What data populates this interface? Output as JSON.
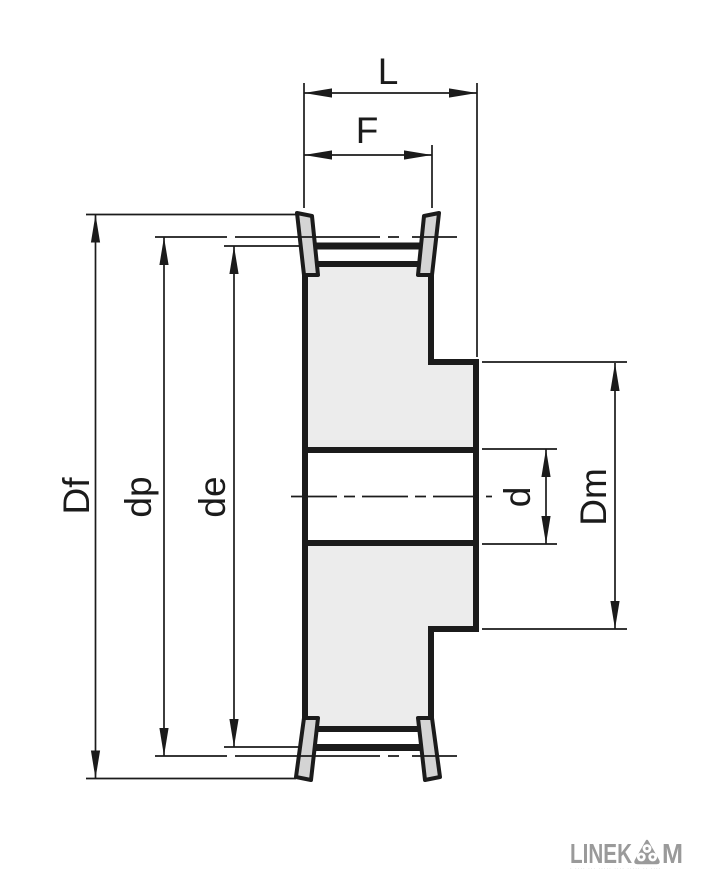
{
  "drawing": {
    "title": "timing-belt-pulley-cross-section",
    "dimension_labels": {
      "overall_length": "L",
      "face_width": "F",
      "flange_diameter": "Df",
      "pitch_diameter": "dp",
      "outside_diameter": "de",
      "bore_diameter": "d",
      "hub_diameter": "Dm"
    },
    "colors": {
      "line": "#1b1b1b",
      "body_fill": "#ececec",
      "flange_fill": "#d4d4d4",
      "background": "#ffffff"
    }
  },
  "logo": {
    "word_start": "LINEK",
    "word_end": "M",
    "icon": "three-rollers-emblem-icon",
    "color": "#9a9a9a",
    "tagline_illegible": "· ···· ··· ····· ···· ····· ·· ····"
  }
}
